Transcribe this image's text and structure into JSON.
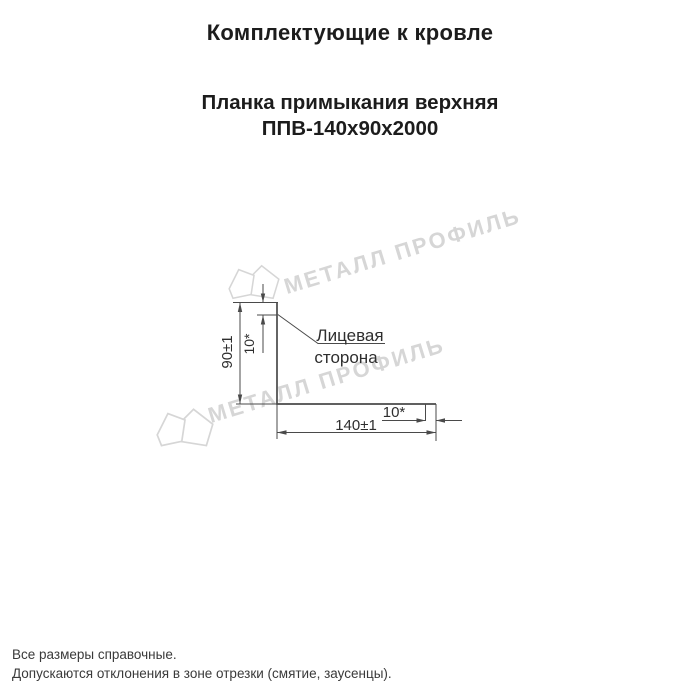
{
  "header": {
    "title": "Комплектующие к кровле",
    "product_line1": "Планка примыкания верхняя",
    "product_line2": "ППВ-140х90х2000"
  },
  "drawing": {
    "labels": {
      "height_dim": "90±1",
      "top_hem_dim": "10*",
      "face_side_line1": "Лицевая",
      "face_side_line2": "сторона",
      "right_hem_dim": "10*",
      "width_dim": "140±1"
    }
  },
  "watermark": {
    "text": "МЕТАЛЛ ПРОФИЛЬ",
    "color": "#d6d6d6"
  },
  "footer": {
    "note1": "Все размеры справочные.",
    "note2": "Допускаются отклонения в зоне отрезки (смятие, заусенцы)."
  },
  "colors": {
    "line": "#4a4a4a",
    "text": "#2e2e2e",
    "watermark": "#d6d6d6"
  }
}
